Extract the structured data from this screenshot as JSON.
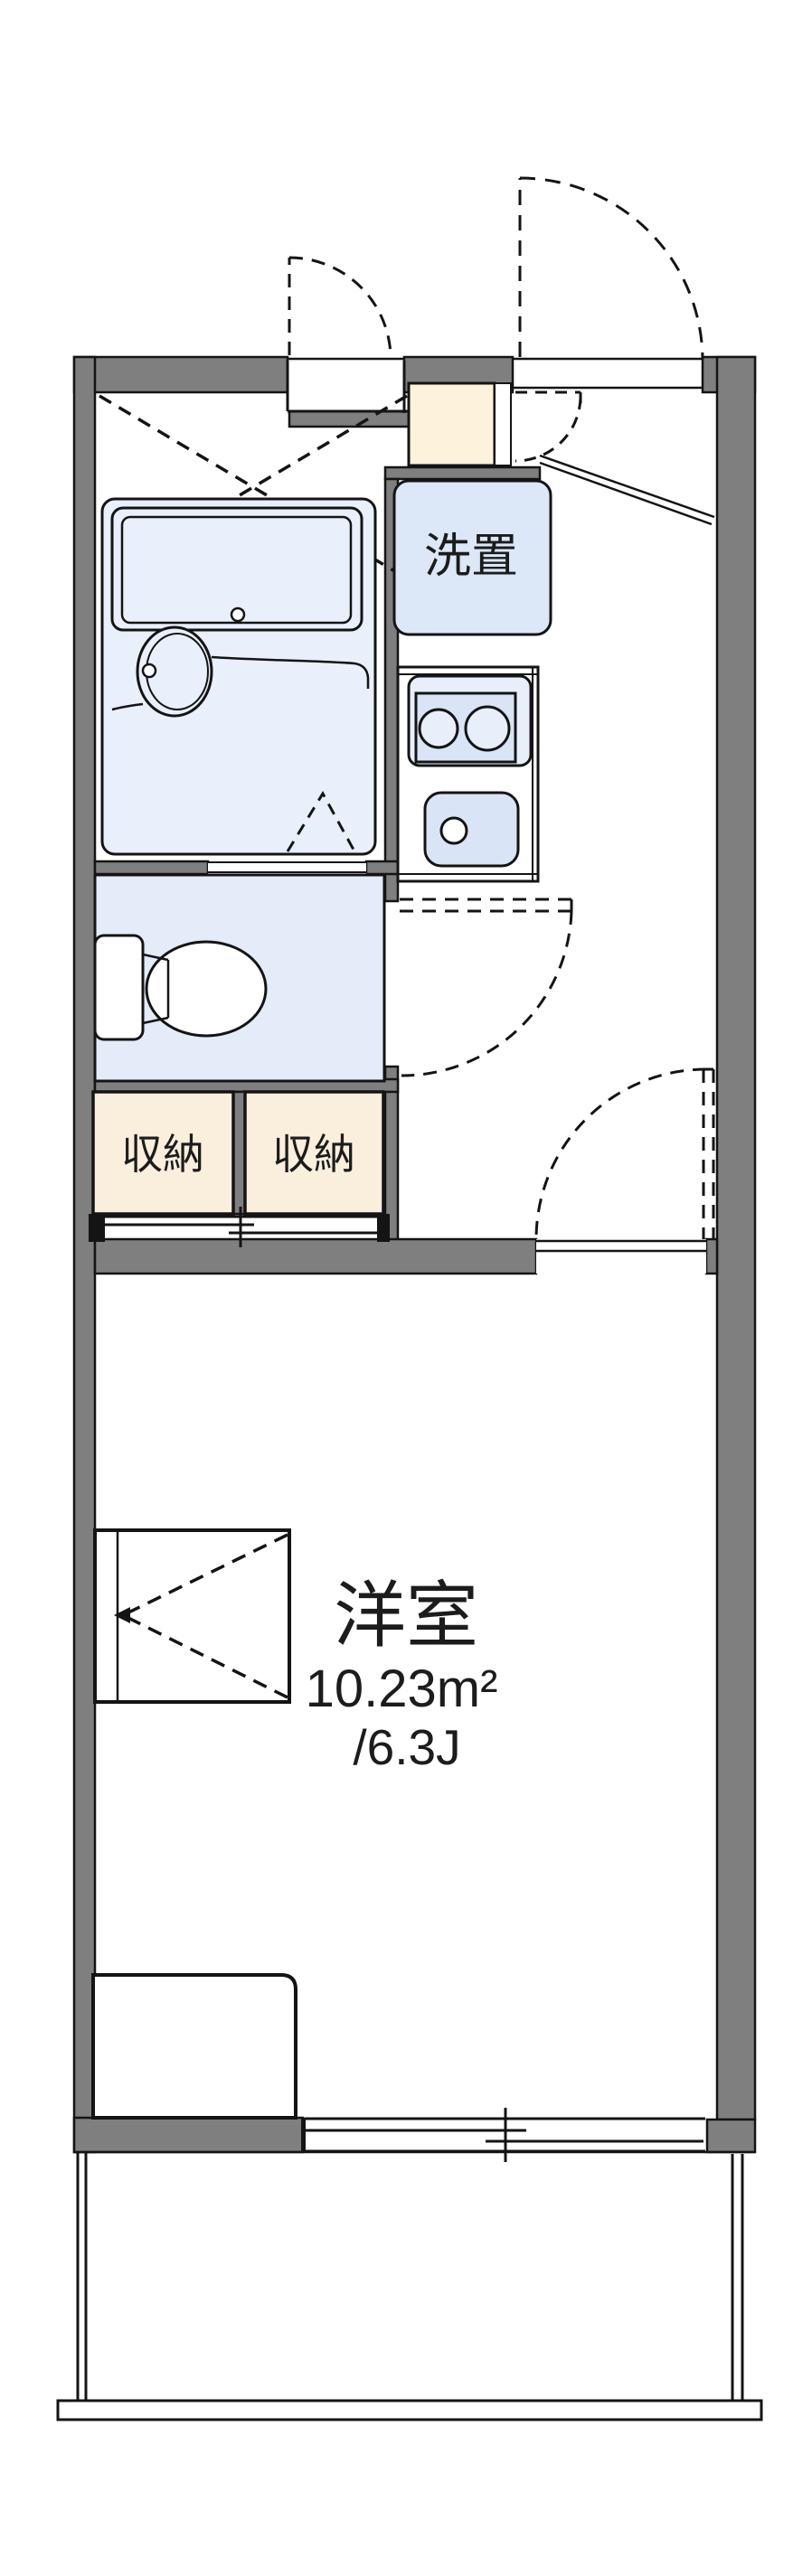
{
  "document": {
    "type": "apartment-floor-plan",
    "style": "japanese-1K-madori"
  },
  "labels": {
    "washer": "洗置",
    "storage_left": "収納",
    "storage_right": "収納",
    "room": "洋室",
    "room_area": "10.23m²",
    "room_tatami": "/6.3J"
  },
  "rooms": {
    "main_room": {
      "name": "洋室",
      "area_sqm": "10.23m²",
      "area_tatami": "/6.3J"
    },
    "washer_space": {
      "name": "洗置"
    },
    "storage_count": 2
  },
  "fixtures": {
    "bath": [
      "bathtub",
      "washbasin",
      "folding-door"
    ],
    "toilet": [
      "toilet-tank",
      "toilet-bowl"
    ],
    "kitchen": [
      "two-burner-stove",
      "kitchen-sink"
    ],
    "bedroom": [
      "bed",
      "closet-box",
      "sliding-window"
    ],
    "exterior": [
      "entrance-door-swing",
      "service-door-swing",
      "balcony"
    ]
  },
  "colors": {
    "wall": "#7f7f7f",
    "line": "#141414",
    "text": "#1c1c1c",
    "bath_fill": "#e9effb",
    "toilet_fill": "#e4ebf9",
    "washer_fill": "#dce7f8",
    "fixture_fill": "#d9e4f6",
    "stove_fill": "#e8effa",
    "storage_fill": "#faeedd",
    "cabinet_fill": "#fdf2dc",
    "floor": "#ffffff"
  }
}
